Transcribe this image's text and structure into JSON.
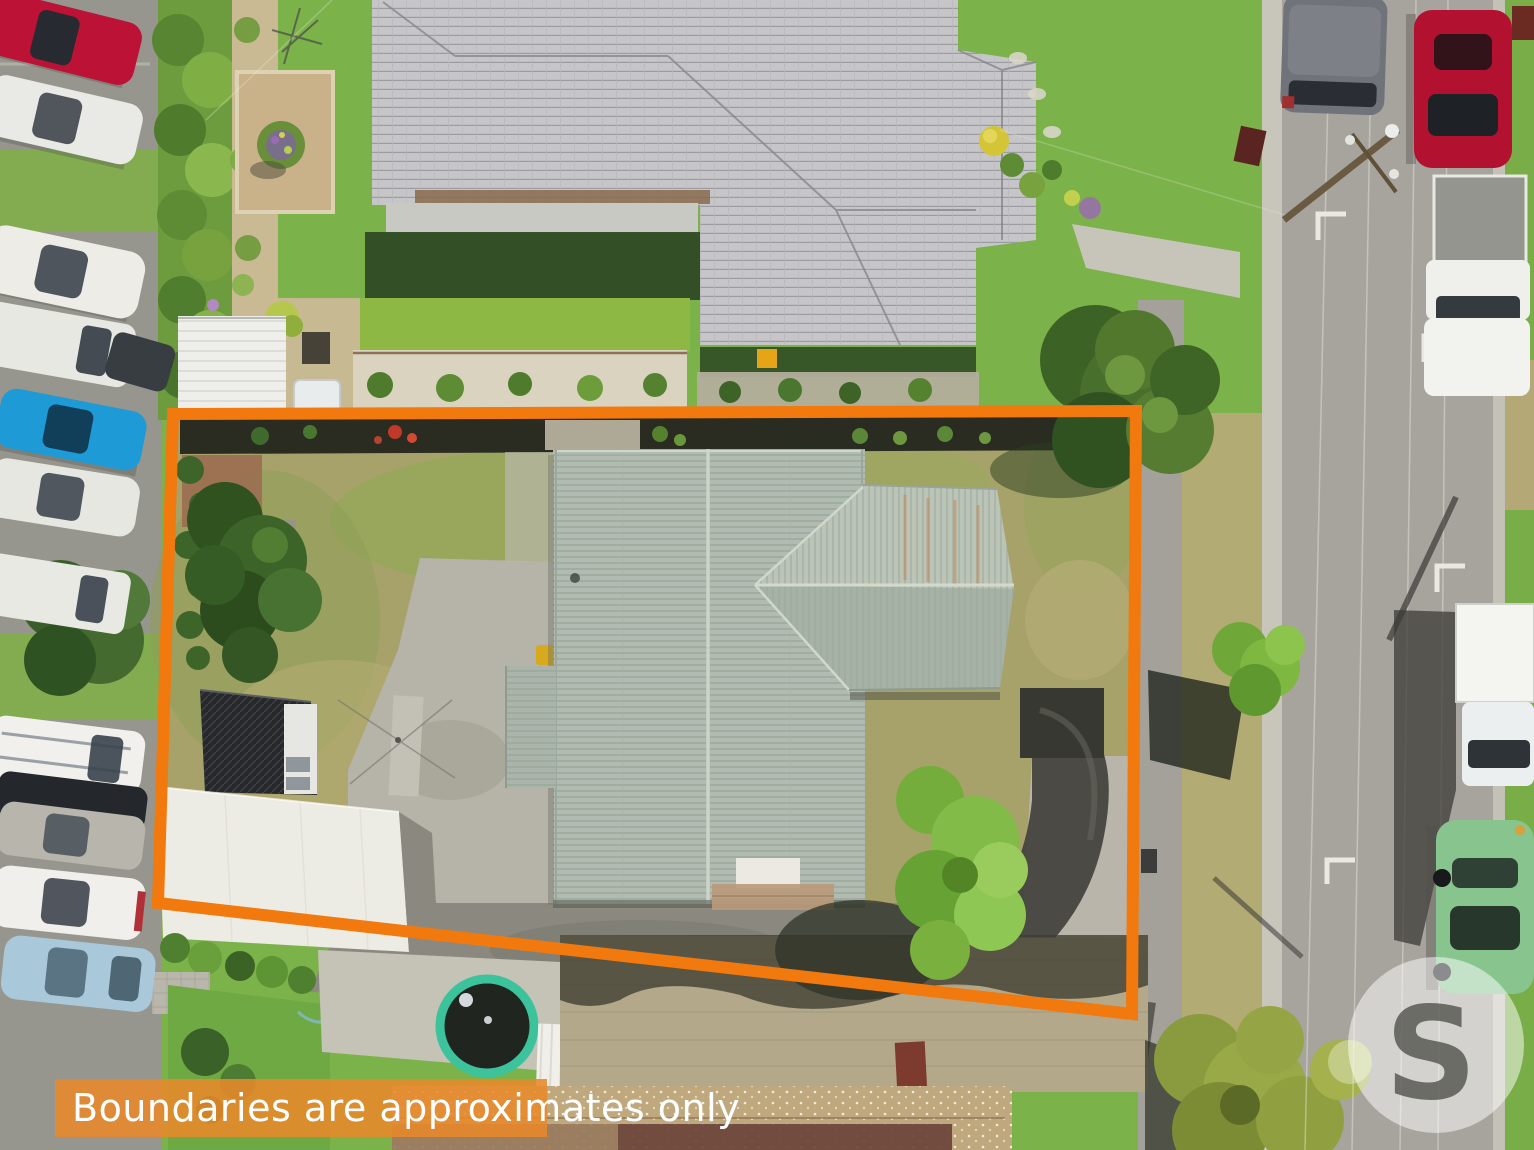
{
  "page": {
    "type": "aerial-property-photo",
    "width": 1534,
    "height": 1150
  },
  "overlay": {
    "disclaimer_banner": {
      "text": "Boundaries are approximates only",
      "text_color": "#FFFFFF",
      "bg_color": "#E8892A"
    },
    "boundary_outline": {
      "color": "#F1790D",
      "style": "solid orange quadrilateral marking the property lot"
    },
    "watermark": {
      "letter": "S",
      "letter_color": "#50504B",
      "circle_color": "#FFFFFF"
    }
  }
}
